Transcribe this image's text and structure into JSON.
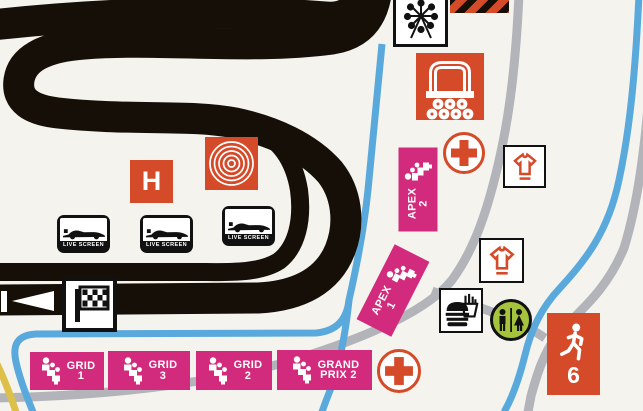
{
  "map": {
    "colors": {
      "bg": "#f4f3ee",
      "track_black": "#160f08",
      "accent_orange": "#d54a28",
      "stand_pink": "#d22a7c",
      "route_blue": "#5aa9dc",
      "road_gray": "#b2b4ba",
      "path_yellow": "#dcc04a",
      "toilet_green": "#a5c33c"
    },
    "stands": {
      "apex2": {
        "line1": "APEX",
        "line2": "2"
      },
      "apex1": {
        "line1": "APEX",
        "line2": "1"
      },
      "grid1": {
        "line1": "GRID",
        "line2": "1"
      },
      "grid3": {
        "line1": "GRID",
        "line2": "3"
      },
      "grid2": {
        "line1": "GRID",
        "line2": "2"
      },
      "grand_prix2": {
        "line1": "GRAND",
        "line2": "PRIX 2"
      }
    },
    "live_screens": [
      {
        "label": "LIVE SCREEN"
      },
      {
        "label": "LIVE SCREEN"
      },
      {
        "label": "LIVE SCREEN"
      }
    ],
    "helipad": {
      "label": "H"
    },
    "gate": {
      "number": "6"
    },
    "icons": {
      "ferris_wheel": "ferris-wheel-icon",
      "covered_grandstand": "covered-grandstand-icon",
      "first_aid": "first-aid-cross-icon",
      "merchandise": "tshirt-icon",
      "food": "burger-fries-icon",
      "toilets": "toilets-icon",
      "exit_gate": "walking-person-icon",
      "start_finish": "checkered-flag-icon",
      "live_screen": "live-screen-icon",
      "grandstand_seats": "grandstand-seats-icon",
      "spiral_marker": "spiral-marker-icon",
      "direction": "race-direction-arrow"
    }
  }
}
